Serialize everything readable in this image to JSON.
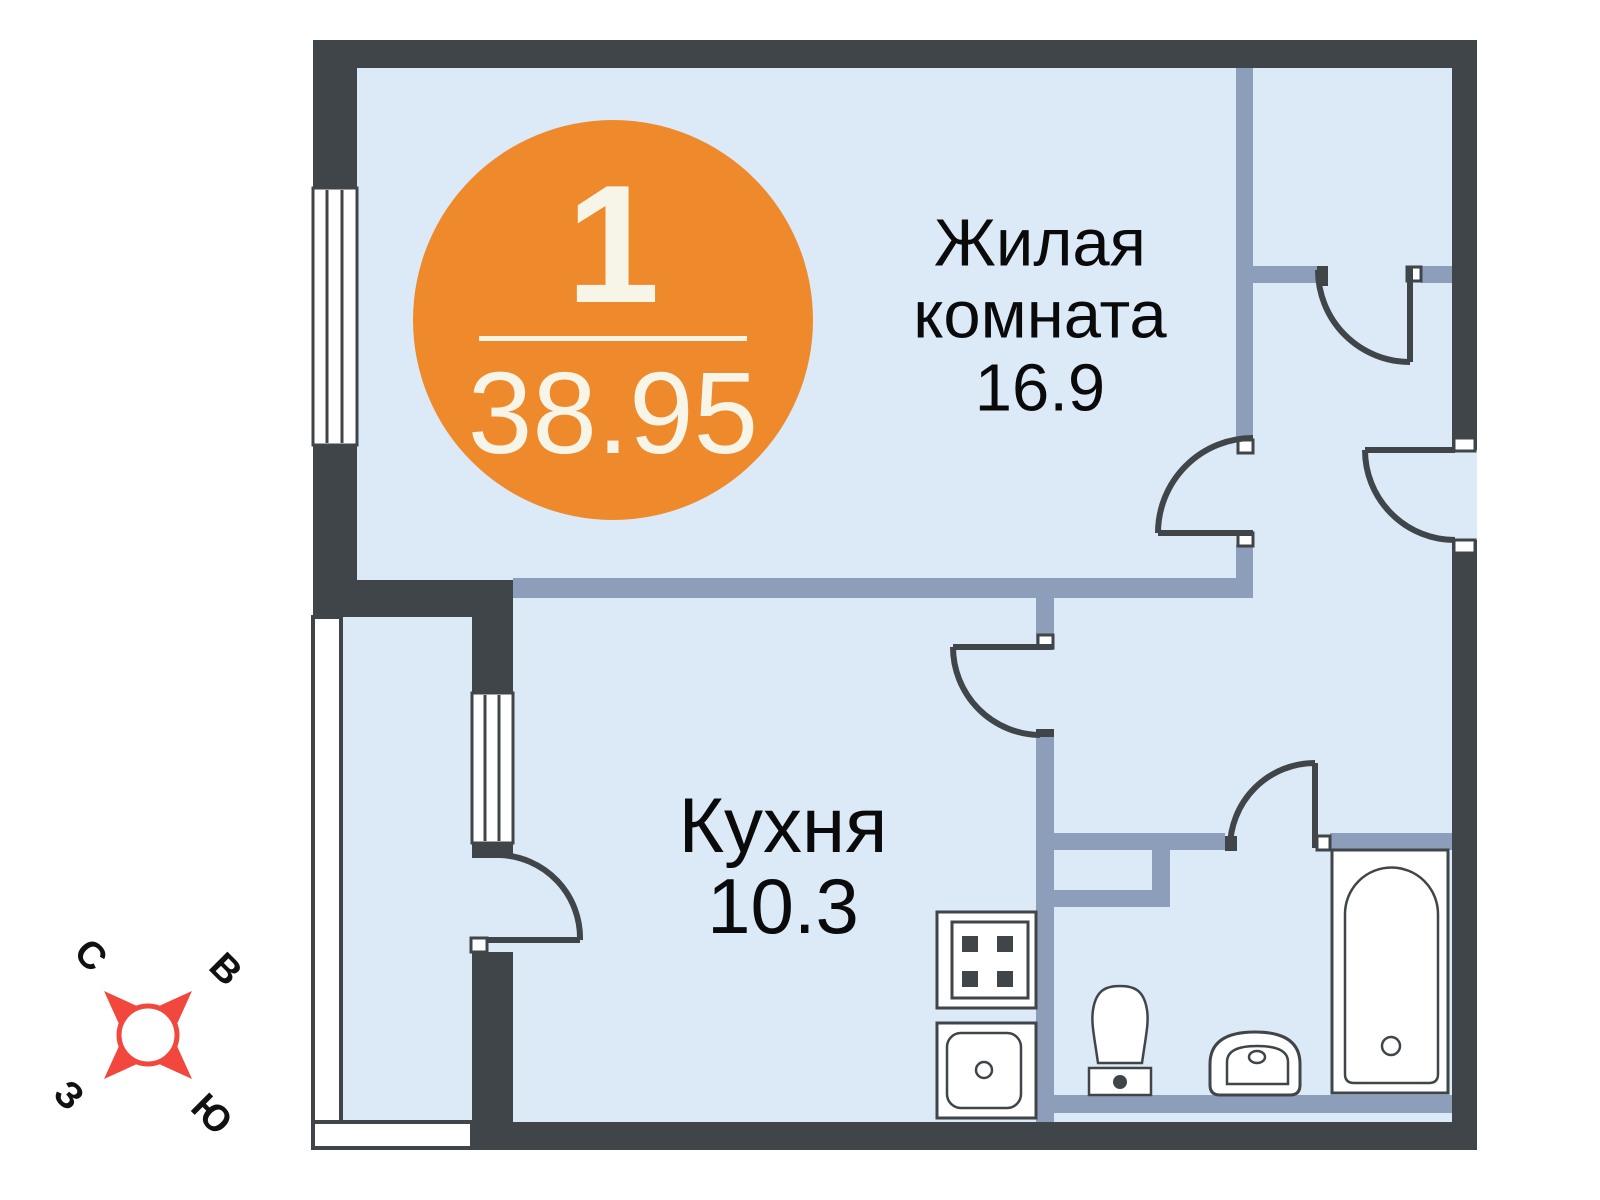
{
  "badge": {
    "room_count": "1",
    "total_area": "38.95"
  },
  "rooms": {
    "living": {
      "name_line1": "Жилая",
      "name_line2": "комната",
      "area": "16.9"
    },
    "kitchen": {
      "name": "Кухня",
      "area": "10.3"
    }
  },
  "compass": {
    "north": "С",
    "east": "В",
    "west": "З",
    "south": "Ю"
  },
  "colors": {
    "wall_dark": "#404549",
    "wall_blue": "#8C9EB9",
    "room_fill": "#DCE9F7",
    "accent_orange": "#EF8A2C",
    "badge_text": "#F7F4E8",
    "compass_red": "#F2473C",
    "label_text": "#0A0A0A",
    "page_bg": "#FFFFFF"
  }
}
